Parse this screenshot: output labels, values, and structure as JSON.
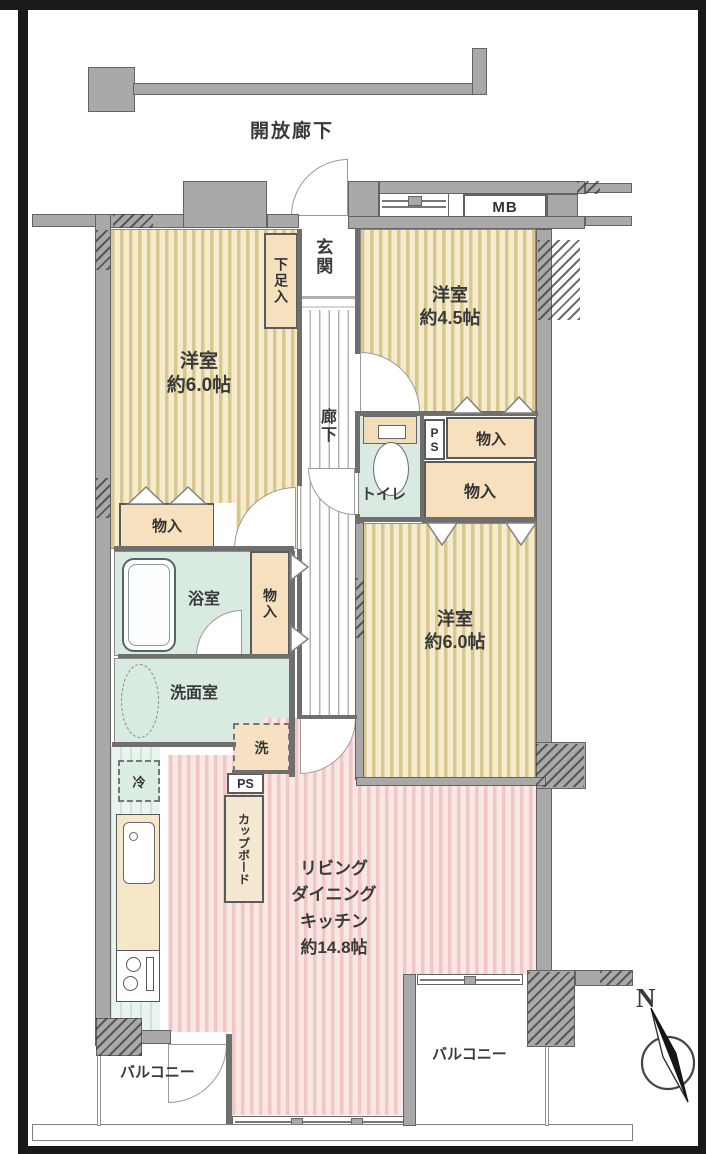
{
  "title_labels": {
    "open_corridor": "開放廊下"
  },
  "rooms": {
    "entrance": "玄関",
    "shoe_cabinet": "下足入",
    "hallway": "廊下",
    "bedroom_left": {
      "name": "洋室",
      "size": "約6.0帖"
    },
    "bedroom_top_right": {
      "name": "洋室",
      "size": "約4.5帖"
    },
    "bedroom_bottom_right": {
      "name": "洋室",
      "size": "約6.0帖"
    },
    "toilet": "トイレ",
    "bathroom": "浴室",
    "washroom": "洗面室",
    "ldk": {
      "line1": "リビング",
      "line2": "ダイニング",
      "line3": "キッチン",
      "size": "約14.8帖"
    },
    "balcony_left": "バルコニー",
    "balcony_right": "バルコニー"
  },
  "fixtures": {
    "storage": "物入",
    "pipe_space": "PS",
    "meter_box": "MB",
    "washing_machine": "洗",
    "refrigerator": "冷",
    "cupboard": "カップボード"
  },
  "compass": {
    "north": "N"
  },
  "colors": {
    "wall_gray": "#a9a9a9",
    "room_beige": "#f5ecce",
    "room_pink": "#fae6e3",
    "wet_area_teal": "#d9eae1",
    "storage_peach": "#f7e0bd",
    "frame_black": "#191919"
  }
}
